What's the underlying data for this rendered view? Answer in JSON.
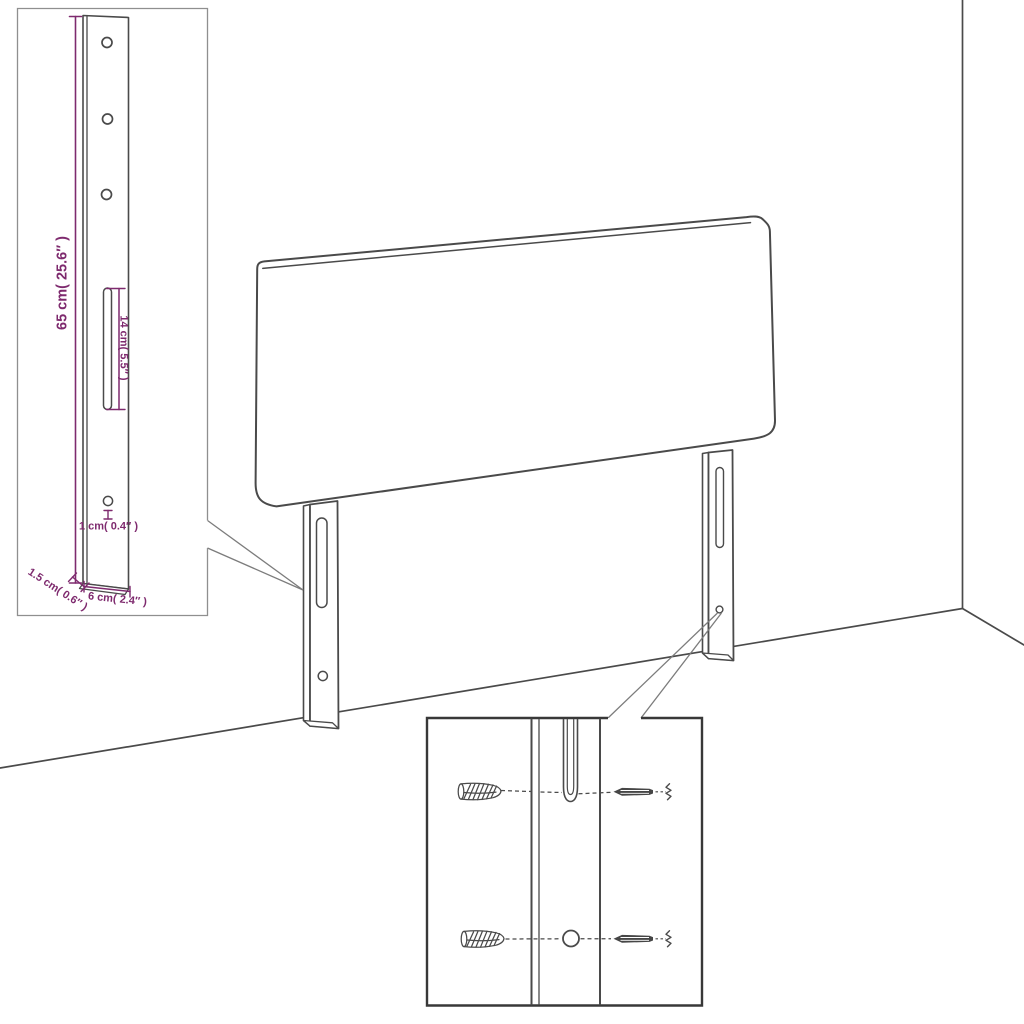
{
  "diagram": {
    "kind": "furniture-assembly-diagram",
    "subject": "headboard-with-mounting-legs",
    "labels": {
      "bracket_height": "65 cm( 25.6″ )",
      "slot_length": "14 cm( 5.5″ )",
      "hole_diameter": "1 cm( 0.4″ )",
      "bracket_thickness": "1.5 cm( 0.6″ )",
      "bracket_width": "6 cm( 2.4″ )"
    },
    "colors": {
      "line_art": "#4a4a4a",
      "dimension": "#7e2a6e",
      "callout": "#7c7c7c",
      "inset1_border": "#8f8f8f",
      "inset2_border": "#383838"
    }
  }
}
